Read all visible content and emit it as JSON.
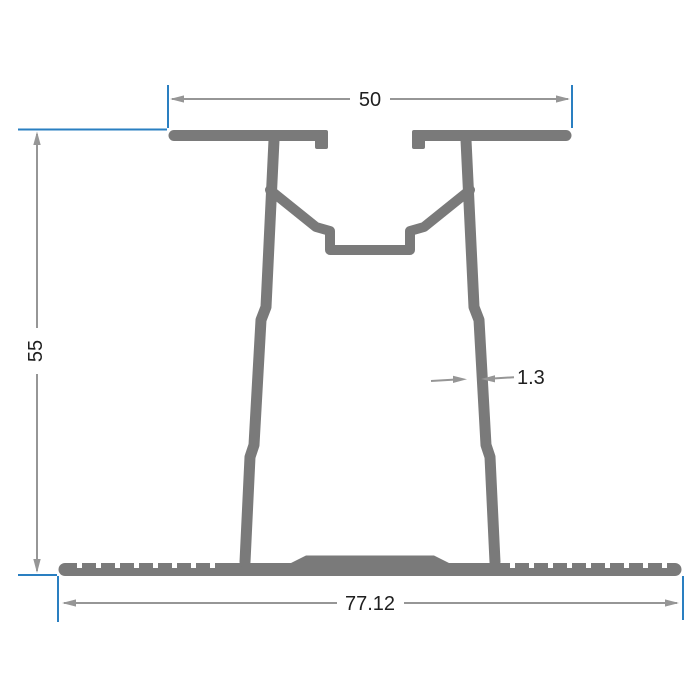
{
  "diagram": {
    "type": "technical-cross-section",
    "description": "Dimensioned cross-section drawing of an aluminum extrusion profile with T-shaped top flange, central screw channel, twin slanted webs and serrated base plate",
    "units_shown": false,
    "dimensions": {
      "top_width": {
        "label": "50",
        "orientation": "horizontal",
        "position": "top"
      },
      "height": {
        "label": "55",
        "orientation": "vertical",
        "position": "left"
      },
      "wall_thickness": {
        "label": "1.3",
        "orientation": "horizontal",
        "position": "middle-right"
      },
      "bottom_width": {
        "label": "77.12",
        "orientation": "horizontal",
        "position": "bottom"
      }
    },
    "colors": {
      "profile": "#7a7a7a",
      "dimension_line": "#969696",
      "extension_line": "#2a7fc1",
      "text": "#1f1f1f",
      "background": "#ffffff"
    }
  }
}
